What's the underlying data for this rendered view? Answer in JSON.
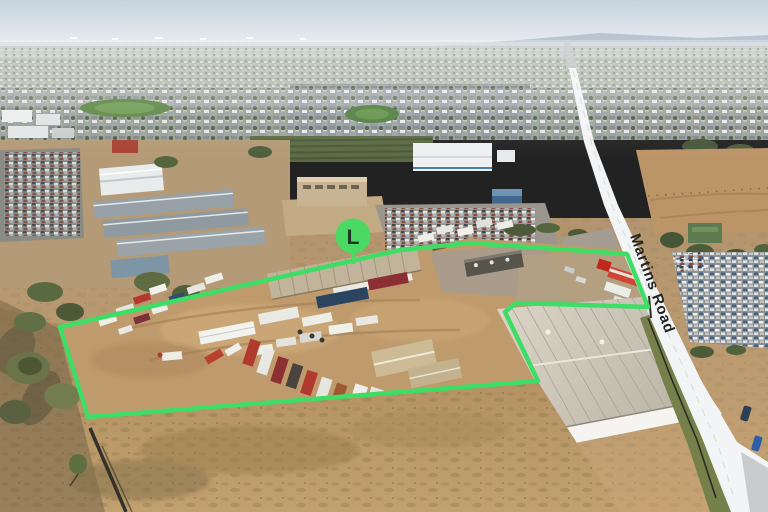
{
  "overlays": {
    "road_label": "Martins Road",
    "marker_label": "L"
  },
  "palette": {
    "boundary_green": "#3EDD66",
    "marker_green": "#4BD963",
    "marker_letter_color": "#1D3526",
    "road_highlight": "#F3F4F5",
    "road_label_color": "#232323",
    "sky_top": "#C6D4E0",
    "dirt_yard": "#BE9A6C"
  }
}
